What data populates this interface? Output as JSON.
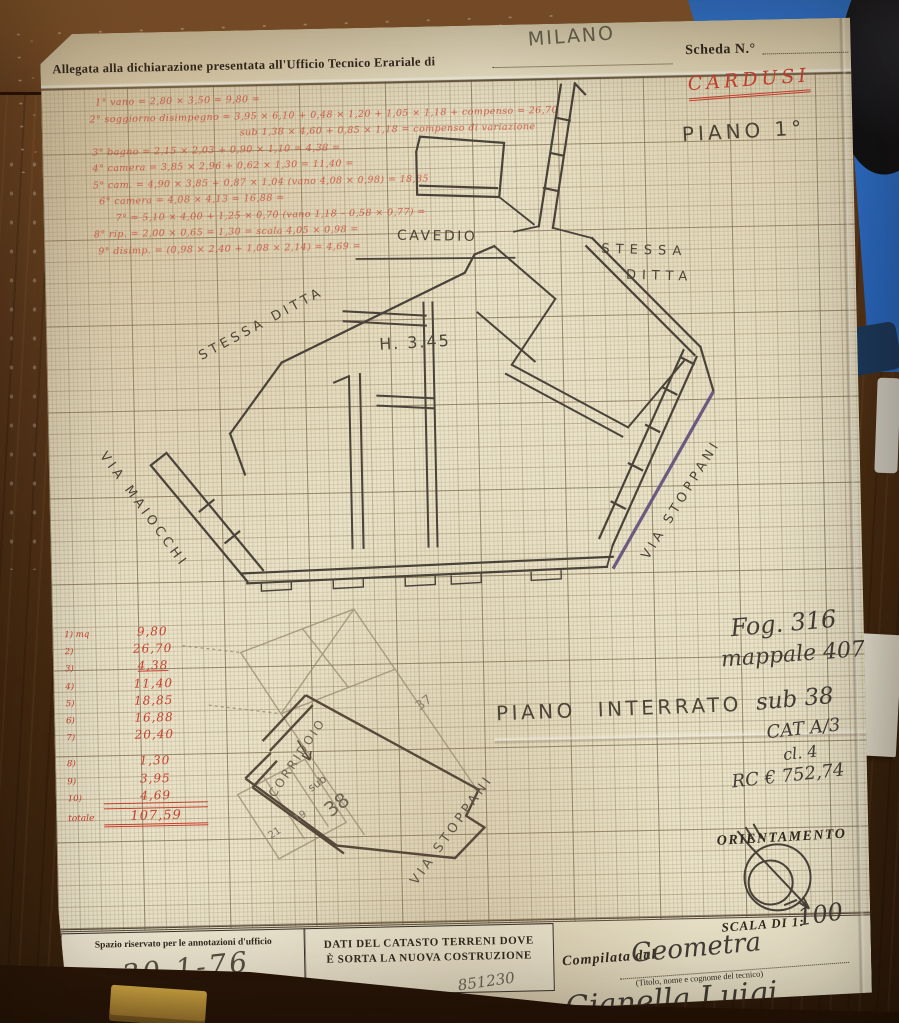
{
  "document": {
    "header": {
      "printed_label": "Allegata alla dichiarazione presentata all'Ufficio Tecnico Erariale di",
      "city": "MILANO",
      "scheda_label": "Scheda N.°"
    },
    "titles": {
      "red_name": "CARDUSI",
      "floor": "PIANO 1°",
      "basement": "PIANO INTERRATO"
    },
    "red_notes": [
      "1° vano = 2,80 × 3,50 = 9,80 =",
      "2° soggiorno disimpegno = 3,95 × 6,10 + 0,48 × 1,20 + 1,05 × 1,18 + compenso = 26,70",
      "sub 1,38 × 4,60 + 0,85 × 1,18 = compenso di variazione",
      "3° bagno = 2,15 × 2,03 + 0,90 × 1,10 = 4,38 =",
      "4° camera = 3,85 × 2,96 + 0,62 × 1,30 = 11,40 =",
      "5° cam. = 4,90 × 3,85 + 0,87 × 1,04 (vano 4,08 × 0,98) = 18,85",
      "6° camera = 4,08 × 4,13 = 16,88 =",
      "7° = 5,10 × 4,00 + 1,25 × 0,70 (vano 1,18 – 0,58 × 0,77) =",
      "8° rip. = 2,00 × 0,65 = 1,30 = scala 4,05 × 0,98 =",
      "9° disimp. = (0,98 × 2,40 + 1,08 × 2,14) = 4,69 ="
    ],
    "measurements": {
      "rows": [
        {
          "label": "1) mq",
          "value": "9,80"
        },
        {
          "label": "2)",
          "value": "26,70"
        },
        {
          "label": "3)",
          "value": "4,38"
        },
        {
          "label": "4)",
          "value": "11,40"
        },
        {
          "label": "5)",
          "value": "18,85"
        },
        {
          "label": "6)",
          "value": "16,88"
        },
        {
          "label": "7)",
          "value": "20,40"
        },
        {
          "label": "8)",
          "value": "1,30"
        },
        {
          "label": "9)",
          "value": "3,95"
        },
        {
          "label": "10)",
          "value": "4,69"
        },
        {
          "label": "totale",
          "value": "107,59"
        }
      ]
    },
    "cadastral": {
      "lines": [
        "Fog. 316",
        "mappale 407",
        "sub 38",
        "CAT A/3",
        "cl. 4",
        "RC € 752,74"
      ]
    },
    "plan_labels": {
      "cavedio": "CAVEDIO",
      "stessa_right_1": "STESSA",
      "stessa_right_2": "DITTA",
      "height": "H. 3.45",
      "stessa_left": "STESSA DITTA",
      "via_maiocchi": "VIA MAIOCCHI",
      "via_stoppani": "VIA STOPPANI",
      "corridoio": "CORRIDOIO",
      "via_stoppani_b": "VIA STOPPANI",
      "sub": "sub",
      "n38": "38",
      "n37": "37",
      "n21": "21",
      "n19": "19"
    },
    "orientation": {
      "label": "ORIENTAMENTO",
      "scale_label": "SCALA DI 1:",
      "scale_value": "100"
    },
    "footer": {
      "left_box": "Spazio riservato per le annotazioni d'ufficio",
      "date": "30-1-76",
      "center_line1": "DATI DEL CATASTO TERRENI DOVE",
      "center_line2": "È SORTA LA NUOVA COSTRUZIONE",
      "compilata": "Compilata dal",
      "role": "Geometra",
      "role_caption": "(Titolo, nome e cognome del tecnico)",
      "name": "Gianella Luigi",
      "number": "851230"
    }
  },
  "colors": {
    "paper": "#eae2c8",
    "ink": "#4a4339",
    "red_hand": "#c7402f",
    "purple_line": "#5e4c7a",
    "blue_object": "#2a6bc6",
    "wood": "#5d3a1c"
  }
}
